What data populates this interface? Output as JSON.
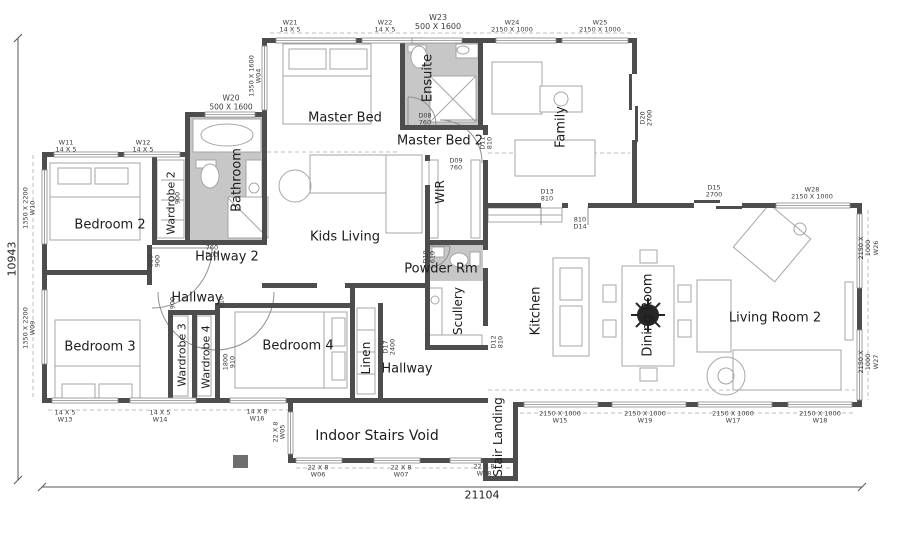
{
  "colors": {
    "wall": "#4d4d4d",
    "furn": "#a6a6a6",
    "wet": "#c7c7c7",
    "dash": "#bdbdbd",
    "text": "#1c1c1c",
    "tag": "#3c3c3c",
    "win": "#8a8a8a",
    "post": "#6e6e6e",
    "plant": "#262626"
  },
  "dimensions": {
    "left": "10943",
    "bottom": "21104"
  },
  "room_labels": [
    {
      "id": "master-bed",
      "text": "Master Bed",
      "x": 345,
      "y": 118,
      "rot": 0,
      "fs": 13
    },
    {
      "id": "ensuite",
      "text": "Ensuite",
      "x": 428,
      "y": 78,
      "rot": -90,
      "fs": 13
    },
    {
      "id": "master-bed-2",
      "text": "Master Bed 2",
      "x": 440,
      "y": 141,
      "rot": 0,
      "fs": 13
    },
    {
      "id": "family",
      "text": "Family",
      "x": 561,
      "y": 127,
      "rot": -90,
      "fs": 13
    },
    {
      "id": "bathroom",
      "text": "Bathroom",
      "x": 237,
      "y": 180,
      "rot": -90,
      "fs": 13
    },
    {
      "id": "bedroom-2",
      "text": "Bedroom 2",
      "x": 110,
      "y": 225,
      "rot": 0,
      "fs": 13
    },
    {
      "id": "wardrobe-2",
      "text": "Wardrobe 2",
      "x": 171,
      "y": 203,
      "rot": -90,
      "fs": 11
    },
    {
      "id": "hallway-2",
      "text": "Hallway 2",
      "x": 227,
      "y": 257,
      "rot": 0,
      "fs": 13
    },
    {
      "id": "hallway-upper",
      "text": "Hallway",
      "x": 197,
      "y": 298,
      "rot": 0,
      "fs": 13
    },
    {
      "id": "kids-living",
      "text": "Kids Living",
      "x": 345,
      "y": 237,
      "rot": 0,
      "fs": 13
    },
    {
      "id": "wir",
      "text": "WIR",
      "x": 440,
      "y": 192,
      "rot": -90,
      "fs": 12
    },
    {
      "id": "powder-rm",
      "text": "Powder Rm",
      "x": 441,
      "y": 269,
      "rot": 0,
      "fs": 13
    },
    {
      "id": "scullery",
      "text": "Scullery",
      "x": 458,
      "y": 311,
      "rot": -90,
      "fs": 12
    },
    {
      "id": "kitchen",
      "text": "Kitchen",
      "x": 536,
      "y": 311,
      "rot": -90,
      "fs": 13
    },
    {
      "id": "dining-room",
      "text": "Dining Room",
      "x": 648,
      "y": 315,
      "rot": -90,
      "fs": 13
    },
    {
      "id": "living-room-2",
      "text": "Living Room 2",
      "x": 775,
      "y": 318,
      "rot": 0,
      "fs": 13
    },
    {
      "id": "bedroom-3",
      "text": "Bedroom 3",
      "x": 100,
      "y": 347,
      "rot": 0,
      "fs": 13
    },
    {
      "id": "wardrobe-3",
      "text": "Wardrobe 3",
      "x": 182,
      "y": 355,
      "rot": -90,
      "fs": 11
    },
    {
      "id": "wardrobe-4",
      "text": "Wardrobe 4",
      "x": 206,
      "y": 357,
      "rot": -90,
      "fs": 11
    },
    {
      "id": "bedroom-4",
      "text": "Bedroom 4",
      "x": 298,
      "y": 346,
      "rot": 0,
      "fs": 13
    },
    {
      "id": "linen",
      "text": "Linen",
      "x": 366,
      "y": 358,
      "rot": -90,
      "fs": 12
    },
    {
      "id": "hallway-lower",
      "text": "Hallway",
      "x": 407,
      "y": 369,
      "rot": 0,
      "fs": 13
    },
    {
      "id": "indoor-stairs-void",
      "text": "Indoor Stairs Void",
      "x": 377,
      "y": 436,
      "rot": 0,
      "fs": 14
    },
    {
      "id": "stair-landing",
      "text": "Stair Landing",
      "x": 498,
      "y": 437,
      "rot": -90,
      "fs": 12
    }
  ],
  "tags": [
    {
      "id": "W21",
      "lines": [
        "W21",
        "14 X 5"
      ],
      "x": 290,
      "y": 27,
      "rot": 0
    },
    {
      "id": "W22",
      "lines": [
        "W22",
        "14 X 5"
      ],
      "x": 385,
      "y": 27,
      "rot": 0
    },
    {
      "id": "W23",
      "lines": [
        "W23",
        "500 X 1600"
      ],
      "x": 438,
      "y": 22,
      "rot": 0,
      "fs": 8
    },
    {
      "id": "W24",
      "lines": [
        "W24",
        "2150 X 1000"
      ],
      "x": 512,
      "y": 27,
      "rot": 0
    },
    {
      "id": "W25",
      "lines": [
        "W25",
        "2150 X 1000"
      ],
      "x": 600,
      "y": 27,
      "rot": 0
    },
    {
      "id": "W20",
      "lines": [
        "W20",
        "500 X 1600"
      ],
      "x": 231,
      "y": 103,
      "rot": 0,
      "fs": 7.5
    },
    {
      "id": "W04",
      "lines": [
        "1350 X 1600",
        "W04"
      ],
      "x": 256,
      "y": 76,
      "rot": -90
    },
    {
      "id": "W10",
      "lines": [
        "1350 X 2200",
        "W10"
      ],
      "x": 30,
      "y": 208,
      "rot": -90
    },
    {
      "id": "W09",
      "lines": [
        "1350 X 2200",
        "W09"
      ],
      "x": 30,
      "y": 328,
      "rot": -90
    },
    {
      "id": "W11",
      "lines": [
        "W11",
        "14 X 5"
      ],
      "x": 66,
      "y": 147,
      "rot": 0
    },
    {
      "id": "W12",
      "lines": [
        "W12",
        "14 X 5"
      ],
      "x": 143,
      "y": 147,
      "rot": 0
    },
    {
      "id": "W13",
      "lines": [
        "14 X 5",
        "W13"
      ],
      "x": 65,
      "y": 417,
      "rot": 0
    },
    {
      "id": "W14",
      "lines": [
        "14 X 5",
        "W14"
      ],
      "x": 160,
      "y": 417,
      "rot": 0
    },
    {
      "id": "W16",
      "lines": [
        "14 X 8",
        "W16"
      ],
      "x": 257,
      "y": 416,
      "rot": 0
    },
    {
      "id": "W05",
      "lines": [
        "22 X 8",
        "W05"
      ],
      "x": 280,
      "y": 432,
      "rot": -90
    },
    {
      "id": "W06",
      "lines": [
        "22 X 8",
        "W06"
      ],
      "x": 318,
      "y": 472,
      "rot": 0
    },
    {
      "id": "W07",
      "lines": [
        "22 X 8",
        "W07"
      ],
      "x": 401,
      "y": 472,
      "rot": 0
    },
    {
      "id": "W08",
      "lines": [
        "22 X 8",
        "W08"
      ],
      "x": 484,
      "y": 471,
      "rot": 0
    },
    {
      "id": "W15",
      "lines": [
        "2150 X 1000",
        "W15"
      ],
      "x": 560,
      "y": 418,
      "rot": 0
    },
    {
      "id": "W19",
      "lines": [
        "2150 X 1000",
        "W19"
      ],
      "x": 645,
      "y": 418,
      "rot": 0
    },
    {
      "id": "W17",
      "lines": [
        "2150 X 1000",
        "W17"
      ],
      "x": 733,
      "y": 418,
      "rot": 0
    },
    {
      "id": "W18",
      "lines": [
        "2150 X 1000",
        "W18"
      ],
      "x": 820,
      "y": 418,
      "rot": 0
    },
    {
      "id": "W26",
      "lines": [
        "2150 X 1000",
        "W26"
      ],
      "x": 869,
      "y": 248,
      "rot": -90
    },
    {
      "id": "W27",
      "lines": [
        "2150 X 1000",
        "W27"
      ],
      "x": 869,
      "y": 362,
      "rot": -90
    },
    {
      "id": "W28",
      "lines": [
        "W28",
        "2150 X 1000"
      ],
      "x": 812,
      "y": 194,
      "rot": 0
    },
    {
      "id": "D20",
      "lines": [
        "D20",
        "2700"
      ],
      "x": 647,
      "y": 118,
      "rot": -90
    },
    {
      "id": "D15",
      "lines": [
        "D15",
        "2700"
      ],
      "x": 714,
      "y": 192,
      "rot": 0
    },
    {
      "id": "D13",
      "lines": [
        "D13",
        "810"
      ],
      "x": 547,
      "y": 196,
      "rot": 0
    },
    {
      "id": "D14",
      "lines": [
        "810",
        "D14"
      ],
      "x": 580,
      "y": 224,
      "rot": 0
    },
    {
      "id": "D08",
      "lines": [
        "D08",
        "760"
      ],
      "x": 425,
      "y": 120,
      "rot": 0
    },
    {
      "id": "D09",
      "lines": [
        "D09",
        "760"
      ],
      "x": 456,
      "y": 165,
      "rot": 0
    },
    {
      "id": "D11",
      "lines": [
        "D11",
        "810"
      ],
      "x": 487,
      "y": 143,
      "rot": -90
    },
    {
      "id": "D03",
      "lines": [
        "760",
        "D03"
      ],
      "x": 212,
      "y": 252,
      "rot": 0
    },
    {
      "id": "D18",
      "lines": [
        "810",
        "900"
      ],
      "x": 155,
      "y": 261,
      "rot": -90
    },
    {
      "id": "hall-900",
      "lines": [
        "900"
      ],
      "x": 173,
      "y": 303,
      "rot": -90
    },
    {
      "id": "hall-810",
      "lines": [
        "810"
      ],
      "x": 222,
      "y": 302,
      "rot": -90
    },
    {
      "id": "wr2-900",
      "lines": [
        "900"
      ],
      "x": 178,
      "y": 198,
      "rot": -90
    },
    {
      "id": "D16",
      "lines": [
        "1800",
        "910"
      ],
      "x": 230,
      "y": 362,
      "rot": -90
    },
    {
      "id": "D17",
      "lines": [
        "D17",
        "2400"
      ],
      "x": 390,
      "y": 347,
      "rot": -90
    },
    {
      "id": "D12",
      "lines": [
        "D12",
        "810"
      ],
      "x": 498,
      "y": 342,
      "rot": -90
    },
    {
      "id": "D10",
      "lines": [
        "D10",
        "610"
      ],
      "x": 430,
      "y": 257,
      "rot": -90
    }
  ],
  "walls": [
    [
      262,
      38,
      375,
      5
    ],
    [
      262,
      38,
      5,
      84
    ],
    [
      185,
      112,
      82,
      5
    ],
    [
      185,
      112,
      5,
      133
    ],
    [
      42,
      152,
      148,
      5
    ],
    [
      42,
      152,
      5,
      251
    ],
    [
      42,
      270,
      106,
      5
    ],
    [
      42,
      398,
      446,
      5
    ],
    [
      152,
      155,
      5,
      88
    ],
    [
      152,
      240,
      115,
      5
    ],
    [
      262,
      117,
      5,
      128
    ],
    [
      400,
      38,
      5,
      91
    ],
    [
      400,
      125,
      88,
      5
    ],
    [
      478,
      38,
      5,
      91
    ],
    [
      632,
      38,
      5,
      36
    ],
    [
      632,
      140,
      5,
      68
    ],
    [
      483,
      125,
      5,
      10
    ],
    [
      483,
      160,
      5,
      48
    ],
    [
      425,
      155,
      5,
      6
    ],
    [
      425,
      185,
      5,
      103
    ],
    [
      425,
      240,
      62,
      5
    ],
    [
      483,
      208,
      5,
      42
    ],
    [
      483,
      268,
      5,
      58
    ],
    [
      425,
      288,
      5,
      60
    ],
    [
      425,
      345,
      63,
      5
    ],
    [
      262,
      283,
      55,
      5
    ],
    [
      345,
      283,
      82,
      5
    ],
    [
      215,
      303,
      140,
      5
    ],
    [
      215,
      303,
      5,
      100
    ],
    [
      168,
      310,
      5,
      90
    ],
    [
      192,
      310,
      5,
      90
    ],
    [
      168,
      310,
      50,
      5
    ],
    [
      147,
      245,
      5,
      40
    ],
    [
      350,
      288,
      5,
      112
    ],
    [
      378,
      303,
      5,
      95
    ],
    [
      288,
      403,
      5,
      60
    ],
    [
      288,
      458,
      230,
      5
    ],
    [
      483,
      461,
      5,
      18
    ],
    [
      483,
      476,
      35,
      5
    ],
    [
      513,
      402,
      5,
      79
    ],
    [
      513,
      402,
      349,
      5
    ],
    [
      857,
      203,
      5,
      204
    ],
    [
      483,
      203,
      58,
      5
    ],
    [
      562,
      203,
      6,
      5
    ],
    [
      588,
      203,
      106,
      5
    ],
    [
      742,
      203,
      36,
      5
    ],
    [
      850,
      203,
      12,
      5
    ]
  ],
  "wet_areas": [
    [
      190,
      117,
      72,
      123
    ],
    [
      405,
      43,
      73,
      82
    ],
    [
      430,
      245,
      53,
      36
    ]
  ],
  "windows_h": [
    [
      276,
      38,
      80
    ],
    [
      362,
      38,
      62
    ],
    [
      412,
      38,
      50
    ],
    [
      496,
      38,
      60
    ],
    [
      562,
      38,
      66
    ],
    [
      205,
      112,
      50
    ],
    [
      54,
      152,
      64
    ],
    [
      124,
      152,
      56
    ],
    [
      52,
      398,
      66
    ],
    [
      130,
      398,
      66
    ],
    [
      230,
      398,
      56
    ],
    [
      296,
      458,
      46
    ],
    [
      374,
      458,
      46
    ],
    [
      450,
      458,
      31
    ],
    [
      524,
      402,
      74
    ],
    [
      612,
      402,
      74
    ],
    [
      698,
      402,
      74
    ],
    [
      788,
      402,
      64
    ],
    [
      776,
      203,
      74
    ]
  ],
  "windows_v": [
    [
      262,
      46,
      64
    ],
    [
      42,
      170,
      74
    ],
    [
      42,
      290,
      74
    ],
    [
      288,
      412,
      42
    ],
    [
      857,
      214,
      74
    ],
    [
      857,
      330,
      70
    ]
  ],
  "sliders": [
    [
      694,
      200,
      26,
      3
    ],
    [
      716,
      206,
      26,
      3
    ],
    [
      629,
      74,
      3,
      36
    ],
    [
      635,
      106,
      3,
      36
    ]
  ],
  "dashed_lines": [
    [
      270,
      33,
      635,
      33
    ],
    [
      33,
      155,
      33,
      398
    ],
    [
      48,
      410,
      288,
      410
    ],
    [
      520,
      413,
      855,
      413
    ],
    [
      868,
      210,
      868,
      400
    ],
    [
      267,
      152,
      400,
      152
    ],
    [
      488,
      153,
      630,
      153
    ],
    [
      488,
      390,
      855,
      390
    ],
    [
      296,
      468,
      512,
      468
    ]
  ],
  "dim_lines": {
    "left": {
      "x": 18,
      "y1": 38,
      "y2": 480
    },
    "bottom": {
      "y": 487,
      "x1": 42,
      "x2": 862
    }
  },
  "furniture": {
    "rects": [
      [
        283,
        44,
        88,
        80
      ],
      [
        289,
        49,
        37,
        20
      ],
      [
        330,
        49,
        37,
        20
      ],
      [
        50,
        163,
        90,
        77
      ],
      [
        58,
        168,
        33,
        16
      ],
      [
        95,
        168,
        33,
        16
      ],
      [
        55,
        320,
        85,
        78
      ],
      [
        62,
        384,
        33,
        15
      ],
      [
        99,
        384,
        33,
        15
      ],
      [
        235,
        312,
        112,
        76
      ],
      [
        332,
        318,
        13,
        28
      ],
      [
        332,
        352,
        13,
        28
      ],
      [
        492,
        62,
        50,
        52
      ],
      [
        540,
        86,
        42,
        26
      ],
      [
        515,
        140,
        80,
        36
      ],
      [
        310,
        155,
        112,
        38
      ],
      [
        386,
        155,
        36,
        78
      ],
      [
        429,
        160,
        9,
        78
      ],
      [
        471,
        160,
        9,
        78
      ],
      [
        157,
        160,
        27,
        78
      ],
      [
        172,
        316,
        16,
        80
      ],
      [
        197,
        316,
        14,
        80
      ],
      [
        357,
        308,
        18,
        86
      ],
      [
        488,
        208,
        74,
        14
      ],
      [
        553,
        258,
        36,
        98
      ],
      [
        560,
        268,
        22,
        32
      ],
      [
        560,
        306,
        22,
        40
      ],
      [
        622,
        266,
        52,
        100
      ],
      [
        640,
        250,
        17,
        13
      ],
      [
        640,
        368,
        17,
        13
      ],
      [
        603,
        285,
        13,
        17
      ],
      [
        603,
        320,
        13,
        17
      ],
      [
        678,
        285,
        13,
        17
      ],
      [
        678,
        320,
        13,
        17
      ],
      [
        697,
        280,
        34,
        72
      ],
      [
        733,
        350,
        108,
        40
      ],
      [
        845,
        282,
        8,
        58
      ],
      [
        745,
        215,
        54,
        56,
        40
      ],
      [
        428,
        288,
        14,
        55
      ],
      [
        428,
        335,
        54,
        12
      ],
      [
        432,
        247,
        12,
        10
      ],
      [
        196,
        160,
        20,
        8
      ],
      [
        246,
        160,
        16,
        48
      ],
      [
        228,
        197,
        40,
        41
      ],
      [
        408,
        45,
        18,
        7
      ],
      [
        456,
        44,
        22,
        14
      ],
      [
        430,
        76,
        46,
        46
      ],
      [
        470,
        252,
        10,
        14
      ],
      [
        193,
        119,
        68,
        33
      ]
    ],
    "circles": [
      [
        295,
        186,
        16
      ],
      [
        561,
        99,
        7
      ],
      [
        800,
        229,
        6
      ],
      [
        254,
        188,
        5
      ],
      [
        435,
        300,
        4
      ],
      [
        726,
        376,
        19
      ],
      [
        726,
        376,
        8
      ]
    ],
    "ellipses": [
      [
        227,
        135,
        26,
        11
      ],
      [
        210,
        176,
        9,
        12
      ],
      [
        419,
        57,
        8,
        11
      ],
      [
        459,
        260,
        9,
        7
      ],
      [
        463,
        50,
        6,
        4
      ]
    ],
    "lines": [
      [
        283,
        76,
        371,
        76
      ],
      [
        50,
        197,
        140,
        197
      ],
      [
        55,
        366,
        140,
        366
      ],
      [
        324,
        312,
        324,
        388
      ],
      [
        430,
        76,
        476,
        122
      ],
      [
        476,
        76,
        430,
        122
      ],
      [
        228,
        198,
        268,
        238
      ],
      [
        488,
        215,
        562,
        215
      ],
      [
        357,
        330,
        375,
        330
      ],
      [
        357,
        352,
        375,
        352
      ],
      [
        357,
        374,
        375,
        374
      ],
      [
        161,
        180,
        184,
        180
      ],
      [
        161,
        200,
        184,
        200
      ],
      [
        161,
        220,
        184,
        220
      ]
    ],
    "door_arcs": [
      "M 152,248 L 212,248 M 212,248 A 60 60 0 0 1 152,308",
      "M 158,292 A 58 58 0 0 0 274,292",
      "M 482,120 L 440,120 M 440,120 A 42 42 0 0 1 482,163",
      "M 408,125 L 408,97 M 408,97 A 28 28 0 0 1 436,125",
      "M 428,246 L 450,246 M 450,246 A 22 22 0 0 1 428,268",
      "M 541,207 L 541,225",
      "M 588,207 L 588,225"
    ],
    "posts": [
      [
        233,
        455,
        15,
        13
      ]
    ],
    "plant": {
      "cx": 648,
      "cy": 315,
      "r": 11
    }
  }
}
